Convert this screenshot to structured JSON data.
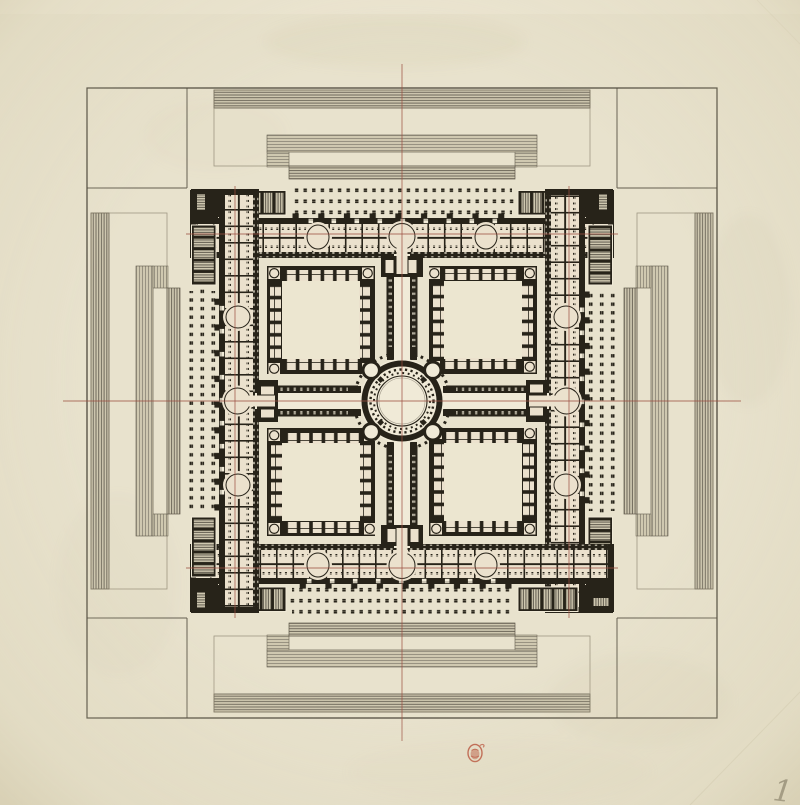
{
  "canvas": {
    "width": 800,
    "height": 805
  },
  "colors": {
    "paper": "#e8e2cd",
    "paper_light": "#f0ead7",
    "paper_dark": "#d7cfb2",
    "room_cream": "#ebe1cd",
    "court_cream": "#ece6d0",
    "ink": "#272319",
    "ink_soft": "#5e584a",
    "hatch_dark": "#6f695b",
    "hatch_mid": "#8a8474",
    "hatch_light": "#cfc8b0",
    "red_line": "#9d4f41",
    "stamp_red": "#b5452d",
    "pencil": "#6f6858",
    "frame_line": "#423d31",
    "faint_line": "#857e6a"
  },
  "annotations": {
    "page_number": "1",
    "stamp_name": "red-oval-collection-stamp"
  },
  "geometry": {
    "plan_center": {
      "x": 402,
      "y": 401
    },
    "outer_platform_square": {
      "x": 87,
      "y": 88,
      "size": 630
    },
    "building_half_span": 212,
    "rotunda_outer_radius": 48,
    "rotunda_ring_radius": 37,
    "courtyard_count": 4,
    "red_axis_offsets": [
      0,
      167
    ]
  }
}
